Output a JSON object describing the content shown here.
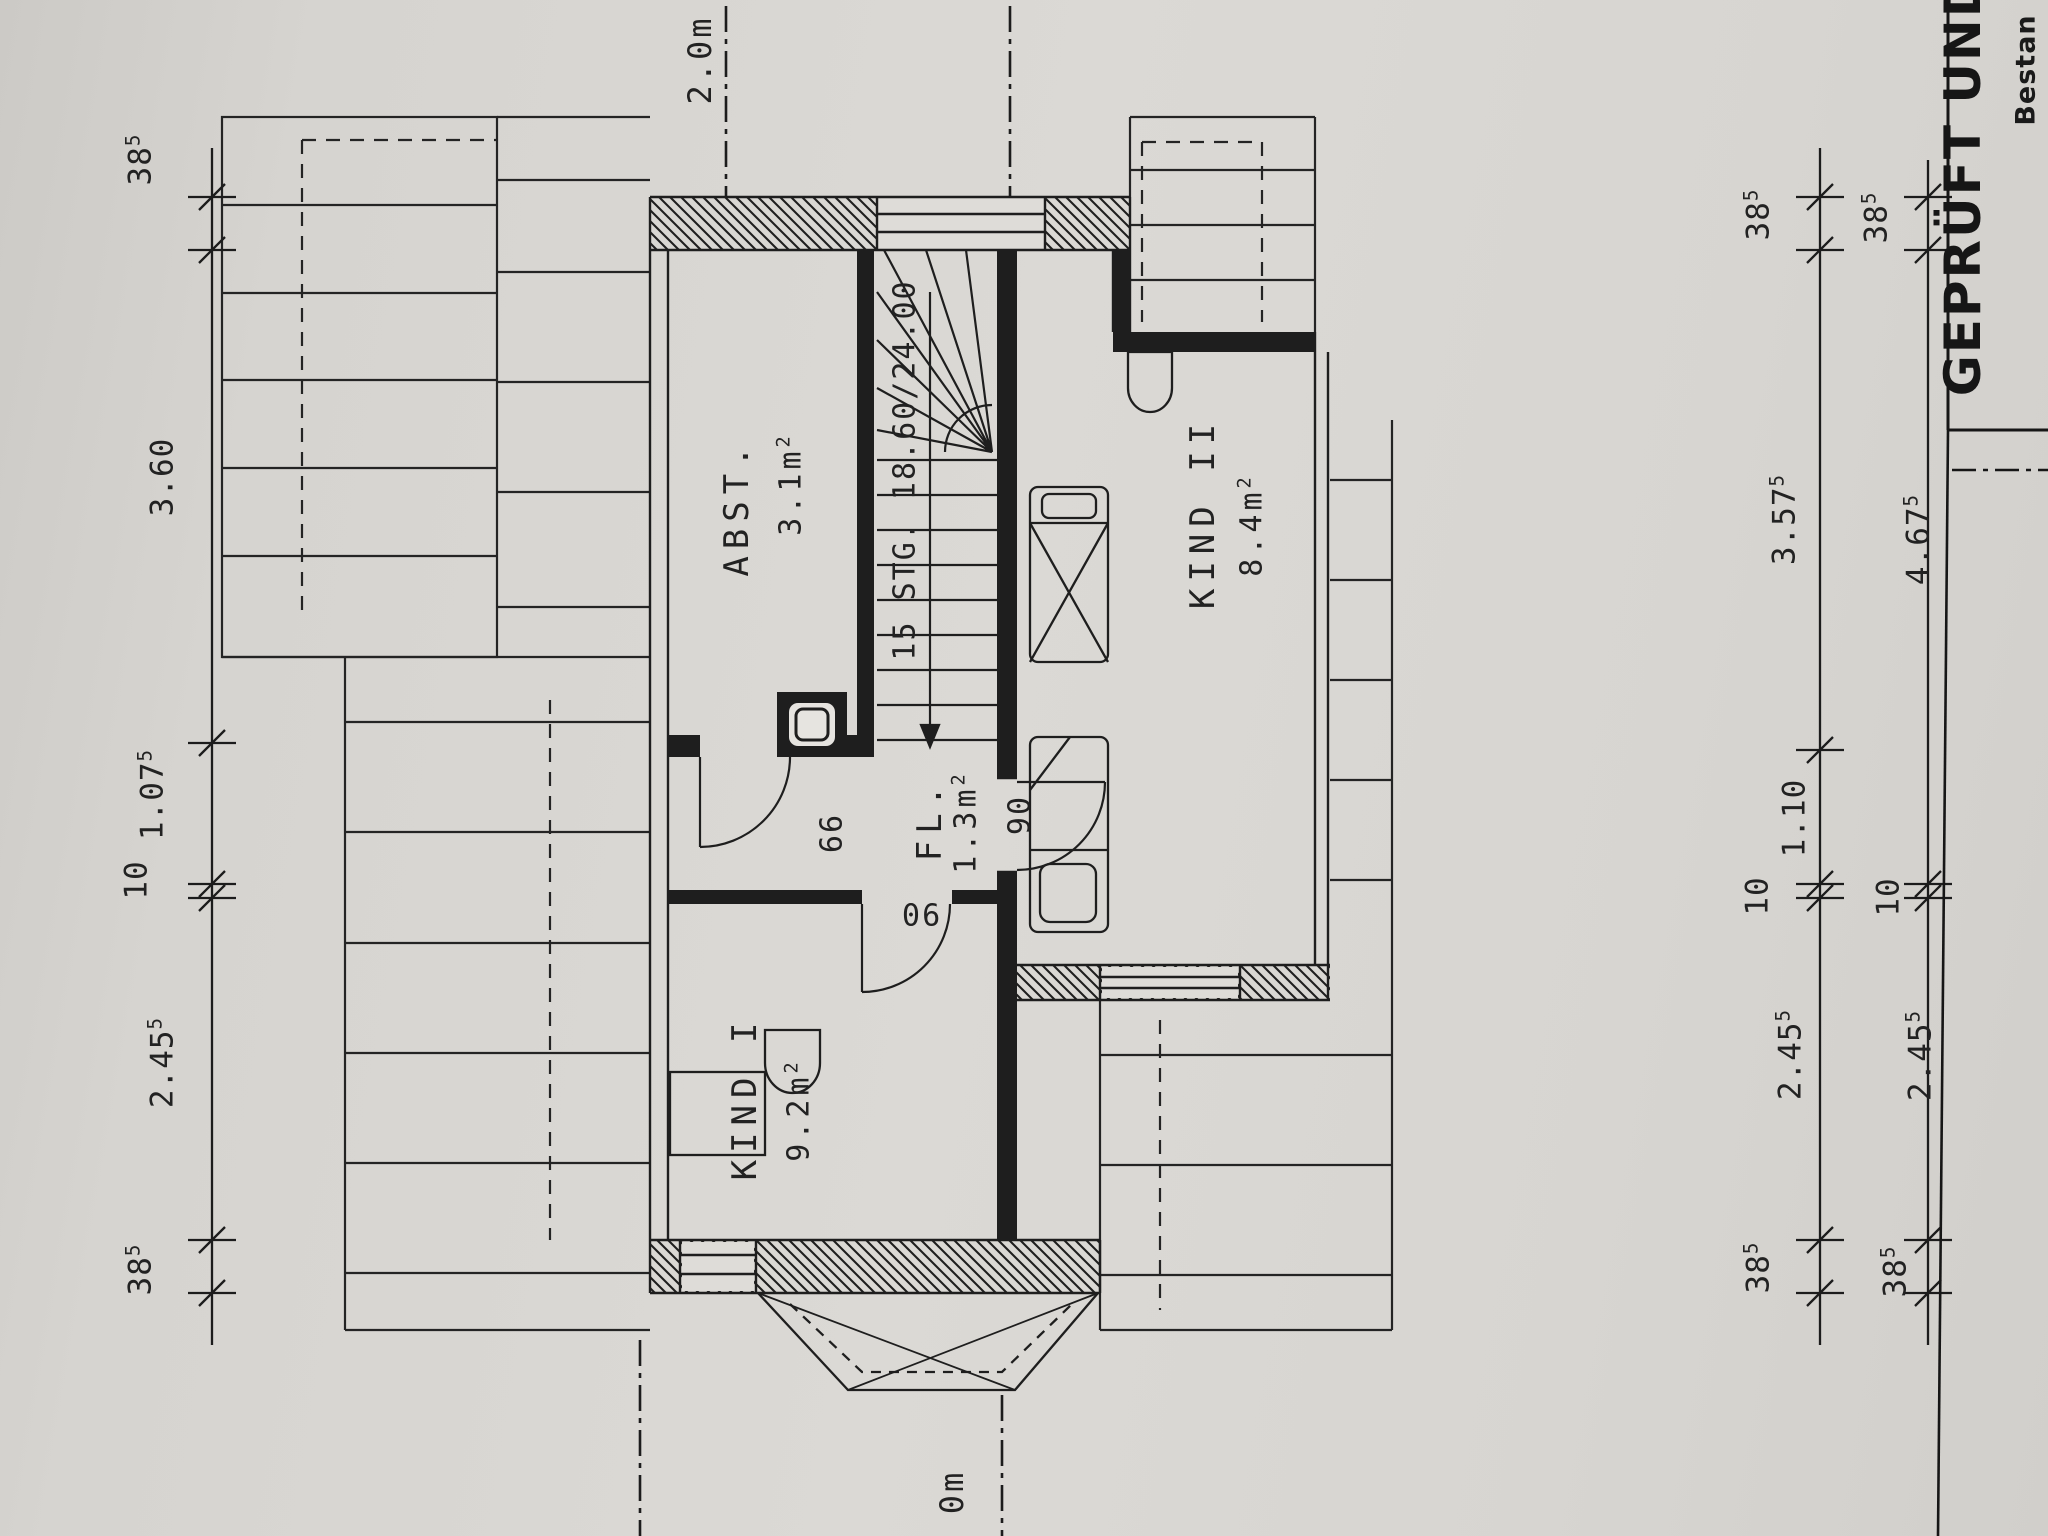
{
  "stamp": {
    "line1": "GEPRÜFT UND",
    "line2": "Bestan"
  },
  "markers": {
    "top": "2.0m",
    "bottom": "0m"
  },
  "rooms": [
    {
      "name": "ABST.",
      "area_value": "3.1",
      "area_unit": "m",
      "area_sup": "2"
    },
    {
      "name": "FL.",
      "area_value": "1.3",
      "area_unit": "m",
      "area_sup": "2"
    },
    {
      "name": "KIND I",
      "area_value": "9.2",
      "area_unit": "m",
      "area_sup": "2"
    },
    {
      "name": "KIND II",
      "area_value": "8.4",
      "area_unit": "m",
      "area_sup": "2"
    }
  ],
  "stairs": {
    "label": "15 STG. 18.60/24.00"
  },
  "doors": [
    {
      "width": "66"
    },
    {
      "width": "90"
    },
    {
      "width": "90"
    }
  ],
  "dimensions": {
    "left": [
      {
        "v": "38",
        "s": "5"
      },
      {
        "v": "3.60",
        "s": ""
      },
      {
        "v": "1.07",
        "s": "5"
      },
      {
        "v": "10",
        "s": ""
      },
      {
        "v": "2.45",
        "s": "5"
      },
      {
        "v": "38",
        "s": "5"
      }
    ],
    "right_inner": [
      {
        "v": "38",
        "s": "5"
      },
      {
        "v": "3.57",
        "s": "5"
      },
      {
        "v": "1.10",
        "s": ""
      },
      {
        "v": "10",
        "s": ""
      },
      {
        "v": "2.45",
        "s": "5"
      },
      {
        "v": "38",
        "s": "5"
      }
    ],
    "right_outer": [
      {
        "v": "38",
        "s": "5"
      },
      {
        "v": "4.67",
        "s": "5"
      },
      {
        "v": "10",
        "s": ""
      },
      {
        "v": "2.45",
        "s": "5"
      },
      {
        "v": "38",
        "s": "5"
      }
    ]
  },
  "colors": {
    "paper": "#d8d6d2",
    "ink": "#1e1e1e"
  }
}
